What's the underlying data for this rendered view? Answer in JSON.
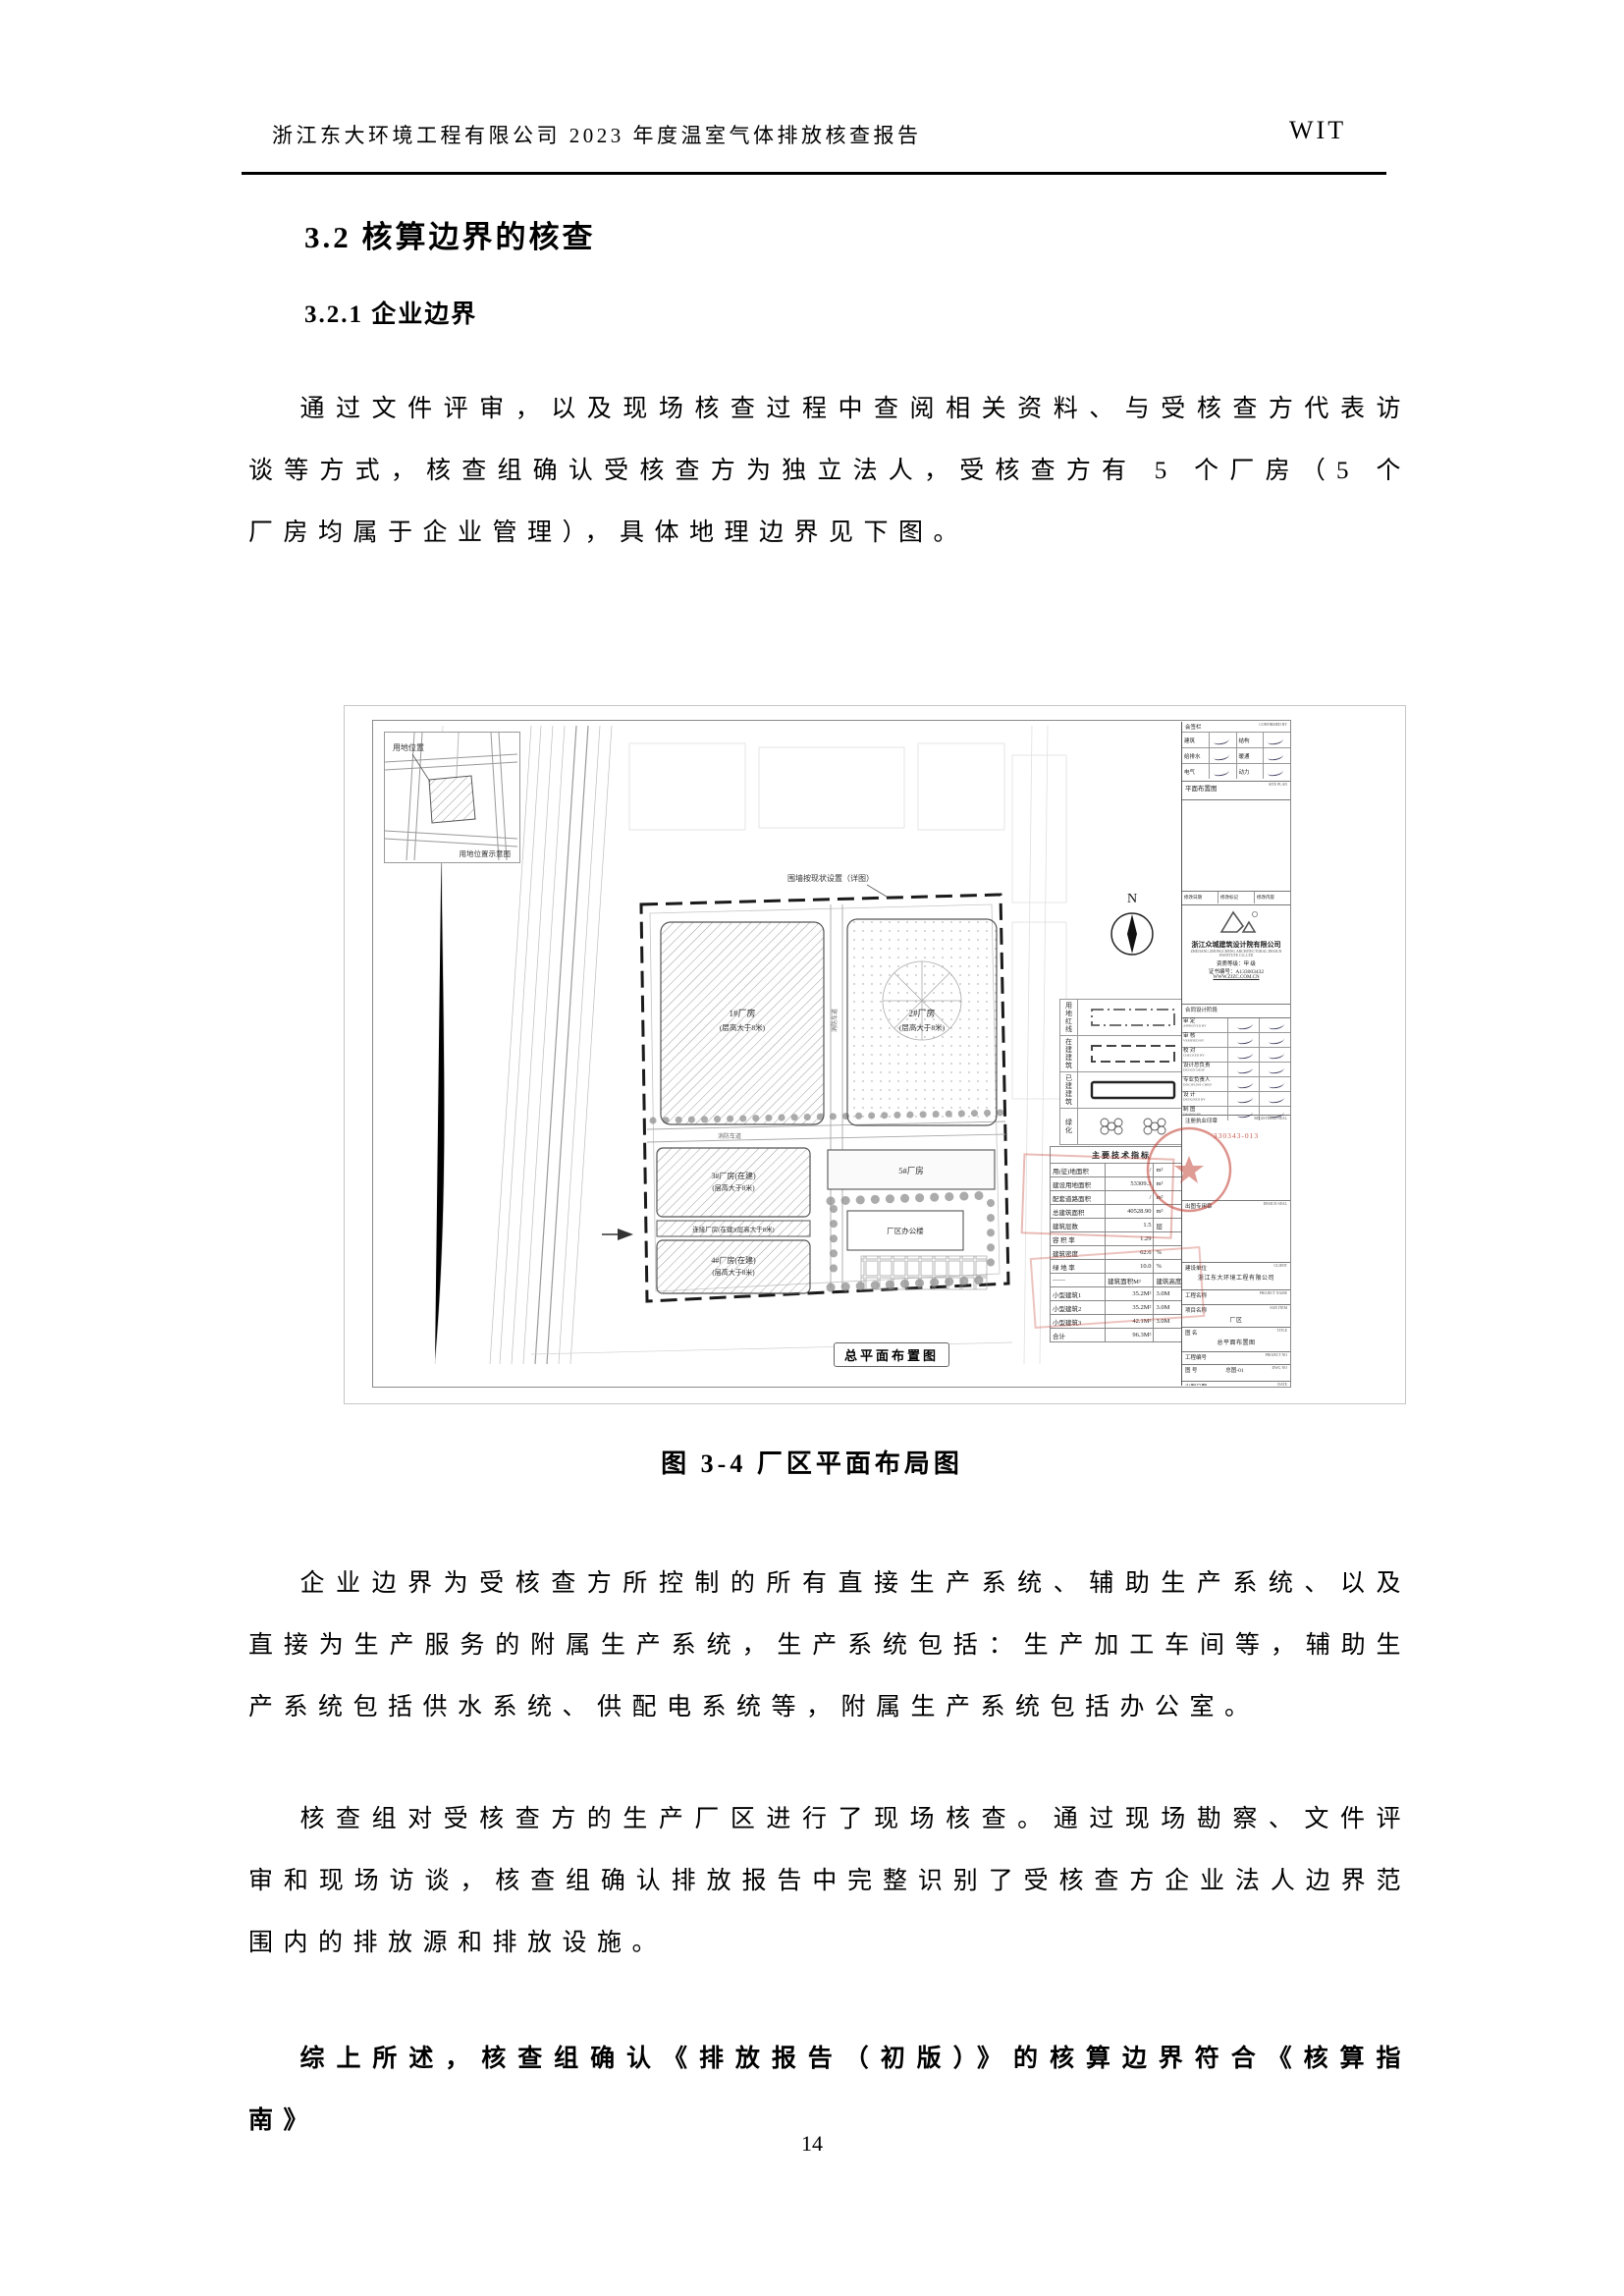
{
  "header": {
    "left": "浙江东大环境工程有限公司 2023 年度温室气体排放核查报告",
    "right": "WIT"
  },
  "headings": {
    "h1": "3.2 核算边界的核查",
    "h2": "3.2.1 企业边界"
  },
  "paragraphs": {
    "p1": "通过文件评审，以及现场核查过程中查阅相关资料、与受核查方代表访谈等方式，核查组确认受核查方为独立法人，受核查方有 5 个厂房（5 个厂房均属于企业管理），具体地理边界见下图。",
    "p2": "企业边界为受核查方所控制的所有直接生产系统、辅助生产系统、以及直接为生产服务的附属生产系统，生产系统包括：生产加工车间等，辅助生产系统包括供水系统、供配电系统等，附属生产系统包括办公室。",
    "p3": "核查组对受核查方的生产厂区进行了现场核查。通过现场勘察、文件评审和现场访谈，核查组确认排放报告中完整识别了受核查方企业法人边界范围内的排放源和排放设施。",
    "p4": "综上所述，核查组确认《排放报告（初版）》的核算边界符合《核算指南》"
  },
  "figure": {
    "caption": "图 3-4  厂区平面布局图",
    "drawing_caption": "总平面布置图",
    "north": "N",
    "inset_label": "用地位置",
    "inset_caption": "用地位置示意图",
    "callout": "围墙按现状设置（详图）",
    "road_label": "消防车道",
    "buildings": [
      {
        "name": "1#厂房",
        "sub": "(层高大于8米)"
      },
      {
        "name": "2#厂房",
        "sub": "(层高大于8米)"
      },
      {
        "name": "3#厂房(在建)",
        "sub": "(层高大于8米)"
      },
      {
        "name": "连接厂房(在建)(层高大于8米)",
        "sub": ""
      },
      {
        "name": "4#厂房(在建)",
        "sub": "(层高大于8米)"
      },
      {
        "name": "5#厂房",
        "sub": ""
      },
      {
        "name": "厂区办公楼",
        "sub": ""
      }
    ],
    "legend": [
      {
        "symbol": "dashdot",
        "label": "用地红线"
      },
      {
        "symbol": "dashed",
        "label": "在建建筑"
      },
      {
        "symbol": "solid",
        "label": "已建建筑"
      },
      {
        "symbol": "trees",
        "label": "绿化"
      }
    ],
    "indicators": {
      "title": "主要技术指标",
      "rows": [
        [
          "用(征)地面积",
          "/",
          "m²"
        ],
        [
          "建设用地面积",
          "53309.3",
          "m²"
        ],
        [
          "配套道路面积",
          "/",
          "m²"
        ],
        [
          "总建筑面积",
          "40528.90",
          "m²"
        ],
        [
          "建筑层数",
          "1.5",
          "层"
        ],
        [
          "容 积 率",
          "1.29",
          ""
        ],
        [
          "建筑密度",
          "62.6",
          "%"
        ],
        [
          "绿 地 率",
          "10.0",
          "%"
        ]
      ],
      "sub_header": [
        "——",
        "建筑面积M²",
        "建筑高度"
      ],
      "sub_rows": [
        [
          "小型建筑1",
          "35.2M²",
          "3.0M"
        ],
        [
          "小型建筑2",
          "35.2M²",
          "3.0M"
        ],
        [
          "小型建筑3",
          "42.1M²",
          "3.0M"
        ],
        [
          "合计",
          "96.3M²",
          ""
        ]
      ]
    },
    "titleblock": {
      "confirm_header": "会签栏",
      "confirm_header_en": "CONFIRMED BY",
      "confirm_rows": [
        [
          "建筑",
          "结构"
        ],
        [
          "给排水",
          "暖通"
        ],
        [
          "电气",
          "动力"
        ]
      ],
      "plan_label": "平面布置图",
      "plan_label_en": "SITE PLAN",
      "revise_row": [
        "修改日期",
        "修改标记",
        "修改内容"
      ],
      "company_cn": "浙江众城建筑设计院有限公司",
      "company_en": "ZHEJIANG ZHONGCHENG ARCHITECTURAL DESIGN INSTITUTE CO.,LTD",
      "grade": "资质等级：甲 级",
      "cert": "证书编号：A133003432",
      "site": "WWW.ZJZC.COM.CN",
      "contract_row": "合同设计阶段",
      "sig_rows": [
        [
          "审 定",
          "APPROVED BY"
        ],
        [
          "审 核",
          "VERIFIED BY"
        ],
        [
          "校 对",
          "CHECKED BY"
        ],
        [
          "设计总负责",
          "DESIGN DESP"
        ],
        [
          "专业负责人",
          "DISCIPLINE CHIEF"
        ],
        [
          "设 计",
          "DESIGNED BY"
        ],
        [
          "制 图",
          "DRAWN BY"
        ]
      ],
      "reg_seal_label": "注册执业印章",
      "reg_seal_en": "REGISTERED SEAL",
      "stamp_number": "330343-013",
      "design_seal_label": "出图专用章",
      "design_seal_en": "DESIGN SEAL",
      "client_label": "建设单位",
      "client_en": "CLIENT",
      "client": "浙江东大环境工程有限公司",
      "project_label": "工程名称",
      "project_en": "PROJECT NAME",
      "subitem_label": "项目名称",
      "subitem_en": "SUB ITEM",
      "subitem": "厂区",
      "title_label": "图 名",
      "title_en": "TITLE",
      "sheet_title": "总平面布置图",
      "projno_label": "工程编号",
      "projno_en": "PROJECT NO",
      "dwgno_label": "图 号",
      "dwgno_en": "DWG NO",
      "dwgno": "总图-01",
      "date_label": "出图日期",
      "date_en": "DATE"
    },
    "colors": {
      "stamp_red": "#c0392b"
    }
  },
  "page_number": "14"
}
